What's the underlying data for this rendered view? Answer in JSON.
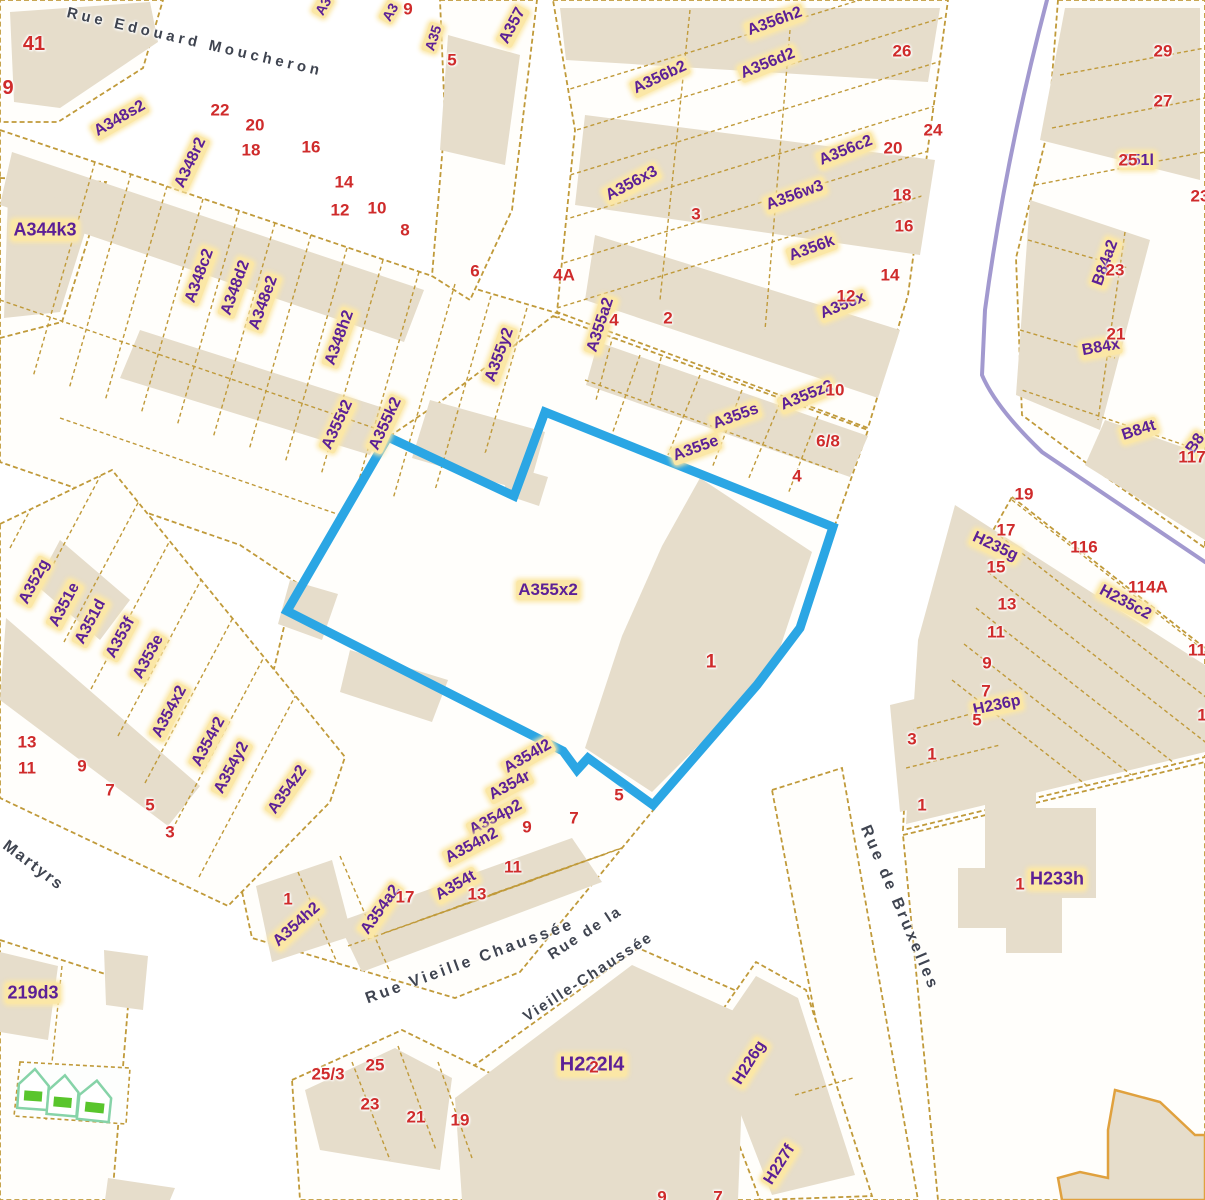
{
  "map": {
    "selection": {
      "parcel_id": "A355x2",
      "building_number": "1",
      "outline_color": "#2ba6e4"
    },
    "colors": {
      "parcel_line": "#c09a3a",
      "building_fill": "#e6ddcb",
      "label_text": "#5c2096",
      "label_halo": "#fbe7a6",
      "number_text": "#cf2b2b",
      "street_text": "#3f4450",
      "boundary_line": "#a299cf",
      "selection_blue": "#2ba6e4",
      "house_icon_green": "#59c52c"
    },
    "parcel_labels": [
      {
        "t": "A344k3",
        "x": 45,
        "y": 230,
        "r": 0,
        "s": 18
      },
      {
        "t": "A348s2",
        "x": 120,
        "y": 119,
        "r": -30
      },
      {
        "t": "A348r2",
        "x": 191,
        "y": 163,
        "r": -65
      },
      {
        "t": "A348c2",
        "x": 200,
        "y": 276,
        "r": -70
      },
      {
        "t": "A348d2",
        "x": 236,
        "y": 288,
        "r": -70
      },
      {
        "t": "A348e2",
        "x": 264,
        "y": 303,
        "r": -70
      },
      {
        "t": "A348h2",
        "x": 340,
        "y": 338,
        "r": -70
      },
      {
        "t": "A355t2",
        "x": 338,
        "y": 425,
        "r": -65
      },
      {
        "t": "A355k2",
        "x": 386,
        "y": 424,
        "r": -65
      },
      {
        "t": "A3",
        "x": 323,
        "y": 6,
        "r": -60,
        "s": 14
      },
      {
        "t": "A3",
        "x": 390,
        "y": 12,
        "r": -60,
        "s": 14
      },
      {
        "t": "A35",
        "x": 433,
        "y": 38,
        "r": -72,
        "s": 14
      },
      {
        "t": "A357",
        "x": 513,
        "y": 26,
        "r": -62
      },
      {
        "t": "A355y2",
        "x": 500,
        "y": 355,
        "r": -70
      },
      {
        "t": "A355a2",
        "x": 601,
        "y": 325,
        "r": -72
      },
      {
        "t": "A356b2",
        "x": 660,
        "y": 78,
        "r": -25
      },
      {
        "t": "A356h2",
        "x": 775,
        "y": 22,
        "r": -20
      },
      {
        "t": "A356d2",
        "x": 768,
        "y": 64,
        "r": -22
      },
      {
        "t": "A356c2",
        "x": 846,
        "y": 151,
        "r": -22
      },
      {
        "t": "A356x3",
        "x": 632,
        "y": 184,
        "r": -28
      },
      {
        "t": "A356w3",
        "x": 795,
        "y": 196,
        "r": -20
      },
      {
        "t": "A356k",
        "x": 812,
        "y": 249,
        "r": -20
      },
      {
        "t": "A356x",
        "x": 843,
        "y": 306,
        "r": -22
      },
      {
        "t": "A355s",
        "x": 736,
        "y": 417,
        "r": -20
      },
      {
        "t": "A355e",
        "x": 696,
        "y": 449,
        "r": -20
      },
      {
        "t": "A355z2",
        "x": 807,
        "y": 396,
        "r": -22
      },
      {
        "t": "A355x2",
        "x": 548,
        "y": 590,
        "r": 0,
        "s": 17
      },
      {
        "t": "A354l2",
        "x": 528,
        "y": 757,
        "r": -30
      },
      {
        "t": "A354r",
        "x": 510,
        "y": 786,
        "r": -28
      },
      {
        "t": "A354p2",
        "x": 496,
        "y": 818,
        "r": -28
      },
      {
        "t": "A354n2",
        "x": 472,
        "y": 846,
        "r": -28
      },
      {
        "t": "A354t",
        "x": 456,
        "y": 886,
        "r": -30
      },
      {
        "t": "A354a2",
        "x": 381,
        "y": 910,
        "r": -55
      },
      {
        "t": "A354h2",
        "x": 297,
        "y": 925,
        "r": -42
      },
      {
        "t": "A354z2",
        "x": 288,
        "y": 790,
        "r": -55
      },
      {
        "t": "A354x2",
        "x": 170,
        "y": 712,
        "r": -62
      },
      {
        "t": "A354r2",
        "x": 209,
        "y": 742,
        "r": -62
      },
      {
        "t": "A354y2",
        "x": 232,
        "y": 768,
        "r": -62
      },
      {
        "t": "A352g",
        "x": 35,
        "y": 582,
        "r": -62
      },
      {
        "t": "A351e",
        "x": 65,
        "y": 605,
        "r": -62
      },
      {
        "t": "A351d",
        "x": 91,
        "y": 622,
        "r": -62
      },
      {
        "t": "A353f",
        "x": 121,
        "y": 638,
        "r": -62
      },
      {
        "t": "A353e",
        "x": 149,
        "y": 657,
        "r": -62
      },
      {
        "t": "B51l",
        "x": 1137,
        "y": 161,
        "r": 0
      },
      {
        "t": "B84a2",
        "x": 1106,
        "y": 263,
        "r": -70
      },
      {
        "t": "B84x",
        "x": 1101,
        "y": 348,
        "r": -10
      },
      {
        "t": "B84t",
        "x": 1139,
        "y": 431,
        "r": -18
      },
      {
        "t": "B8",
        "x": 1196,
        "y": 444,
        "r": -55
      },
      {
        "t": "H235g",
        "x": 995,
        "y": 547,
        "r": 25
      },
      {
        "t": "H235c2",
        "x": 1125,
        "y": 603,
        "r": 28
      },
      {
        "t": "H236p",
        "x": 997,
        "y": 706,
        "r": -12
      },
      {
        "t": "H233h",
        "x": 1057,
        "y": 879,
        "r": 0,
        "s": 18
      },
      {
        "t": "H222l4",
        "x": 592,
        "y": 1065,
        "r": 0,
        "s": 20
      },
      {
        "t": "H226g",
        "x": 750,
        "y": 1063,
        "r": -58
      },
      {
        "t": "H227f",
        "x": 780,
        "y": 1165,
        "r": -58
      },
      {
        "t": "219d3",
        "x": 33,
        "y": 993,
        "r": 0,
        "s": 18
      }
    ],
    "house_numbers": [
      {
        "t": "41",
        "x": 34,
        "y": 44,
        "s": 20
      },
      {
        "t": "9",
        "x": 8,
        "y": 88,
        "s": 20
      },
      {
        "t": "22",
        "x": 220,
        "y": 110
      },
      {
        "t": "20",
        "x": 255,
        "y": 125
      },
      {
        "t": "18",
        "x": 251,
        "y": 150
      },
      {
        "t": "16",
        "x": 311,
        "y": 147
      },
      {
        "t": "14",
        "x": 344,
        "y": 182
      },
      {
        "t": "12",
        "x": 340,
        "y": 210
      },
      {
        "t": "10",
        "x": 377,
        "y": 208
      },
      {
        "t": "8",
        "x": 405,
        "y": 230
      },
      {
        "t": "6",
        "x": 475,
        "y": 271
      },
      {
        "t": "4A",
        "x": 564,
        "y": 275
      },
      {
        "t": "2",
        "x": 668,
        "y": 318
      },
      {
        "t": "4",
        "x": 614,
        "y": 320
      },
      {
        "t": "9",
        "x": 408,
        "y": 9
      },
      {
        "t": "5",
        "x": 452,
        "y": 60
      },
      {
        "t": "26",
        "x": 902,
        "y": 51
      },
      {
        "t": "24",
        "x": 933,
        "y": 130
      },
      {
        "t": "20",
        "x": 893,
        "y": 148
      },
      {
        "t": "18",
        "x": 902,
        "y": 195
      },
      {
        "t": "16",
        "x": 904,
        "y": 226
      },
      {
        "t": "14",
        "x": 890,
        "y": 275
      },
      {
        "t": "12",
        "x": 846,
        "y": 296
      },
      {
        "t": "3",
        "x": 696,
        "y": 214
      },
      {
        "t": "29",
        "x": 1163,
        "y": 51
      },
      {
        "t": "27",
        "x": 1163,
        "y": 101
      },
      {
        "t": "23",
        "x": 1200,
        "y": 196
      },
      {
        "t": "25",
        "x": 1128,
        "y": 160
      },
      {
        "t": "23",
        "x": 1115,
        "y": 270
      },
      {
        "t": "21",
        "x": 1116,
        "y": 334
      },
      {
        "t": "117",
        "x": 1192,
        "y": 457
      },
      {
        "t": "10",
        "x": 835,
        "y": 390
      },
      {
        "t": "6/8",
        "x": 828,
        "y": 441
      },
      {
        "t": "4",
        "x": 797,
        "y": 476
      },
      {
        "t": "1",
        "x": 711,
        "y": 662,
        "s": 19
      },
      {
        "t": "19",
        "x": 1024,
        "y": 494
      },
      {
        "t": "17",
        "x": 1006,
        "y": 530
      },
      {
        "t": "15",
        "x": 996,
        "y": 567
      },
      {
        "t": "116",
        "x": 1084,
        "y": 547
      },
      {
        "t": "114A",
        "x": 1148,
        "y": 587
      },
      {
        "t": "13",
        "x": 1007,
        "y": 604
      },
      {
        "t": "11",
        "x": 996,
        "y": 632
      },
      {
        "t": "9",
        "x": 987,
        "y": 663
      },
      {
        "t": "7",
        "x": 986,
        "y": 691
      },
      {
        "t": "5",
        "x": 977,
        "y": 720
      },
      {
        "t": "11",
        "x": 1197,
        "y": 650
      },
      {
        "t": "1",
        "x": 1202,
        "y": 715
      },
      {
        "t": "3",
        "x": 912,
        "y": 739
      },
      {
        "t": "1",
        "x": 932,
        "y": 754
      },
      {
        "t": "1",
        "x": 922,
        "y": 805
      },
      {
        "t": "13",
        "x": 27,
        "y": 742
      },
      {
        "t": "11",
        "x": 27,
        "y": 768
      },
      {
        "t": "9",
        "x": 82,
        "y": 766
      },
      {
        "t": "7",
        "x": 110,
        "y": 790
      },
      {
        "t": "5",
        "x": 150,
        "y": 805
      },
      {
        "t": "3",
        "x": 170,
        "y": 832
      },
      {
        "t": "9",
        "x": 527,
        "y": 827
      },
      {
        "t": "11",
        "x": 513,
        "y": 867
      },
      {
        "t": "13",
        "x": 477,
        "y": 894
      },
      {
        "t": "17",
        "x": 405,
        "y": 897
      },
      {
        "t": "1",
        "x": 288,
        "y": 899
      },
      {
        "t": "5",
        "x": 619,
        "y": 795
      },
      {
        "t": "7",
        "x": 574,
        "y": 818
      },
      {
        "t": "25/3",
        "x": 328,
        "y": 1074
      },
      {
        "t": "25",
        "x": 375,
        "y": 1065
      },
      {
        "t": "23",
        "x": 370,
        "y": 1104
      },
      {
        "t": "21",
        "x": 416,
        "y": 1117
      },
      {
        "t": "19",
        "x": 460,
        "y": 1120
      },
      {
        "t": "2",
        "x": 594,
        "y": 1067
      },
      {
        "t": "1",
        "x": 1020,
        "y": 884
      },
      {
        "t": "9",
        "x": 662,
        "y": 1197
      },
      {
        "t": "7",
        "x": 718,
        "y": 1197
      }
    ],
    "street_labels": [
      {
        "t": "Rue Edouard Moucheron",
        "x": 195,
        "y": 42,
        "r": 13,
        "s": 15,
        "ls": 4
      },
      {
        "t": "Martyrs",
        "x": 33,
        "y": 866,
        "r": 37,
        "s": 16,
        "ls": 2
      },
      {
        "t": "Rue Vieille Chaussée",
        "x": 470,
        "y": 962,
        "r": -20,
        "s": 16,
        "ls": 3
      },
      {
        "t": "Rue de la",
        "x": 585,
        "y": 933,
        "r": -33,
        "s": 15,
        "ls": 2
      },
      {
        "t": "Vieille-Chaussée",
        "x": 588,
        "y": 977,
        "r": -33,
        "s": 15,
        "ls": 2
      },
      {
        "t": "Rue de Bruxelles",
        "x": 899,
        "y": 908,
        "r": 67,
        "s": 16,
        "ls": 3
      }
    ],
    "icons": [
      {
        "name": "house-icon",
        "x": 20,
        "y": 1068,
        "r": 4
      },
      {
        "name": "house-icon",
        "x": 50,
        "y": 1074,
        "r": 5
      },
      {
        "name": "house-icon",
        "x": 81,
        "y": 1079,
        "r": 6
      }
    ]
  }
}
